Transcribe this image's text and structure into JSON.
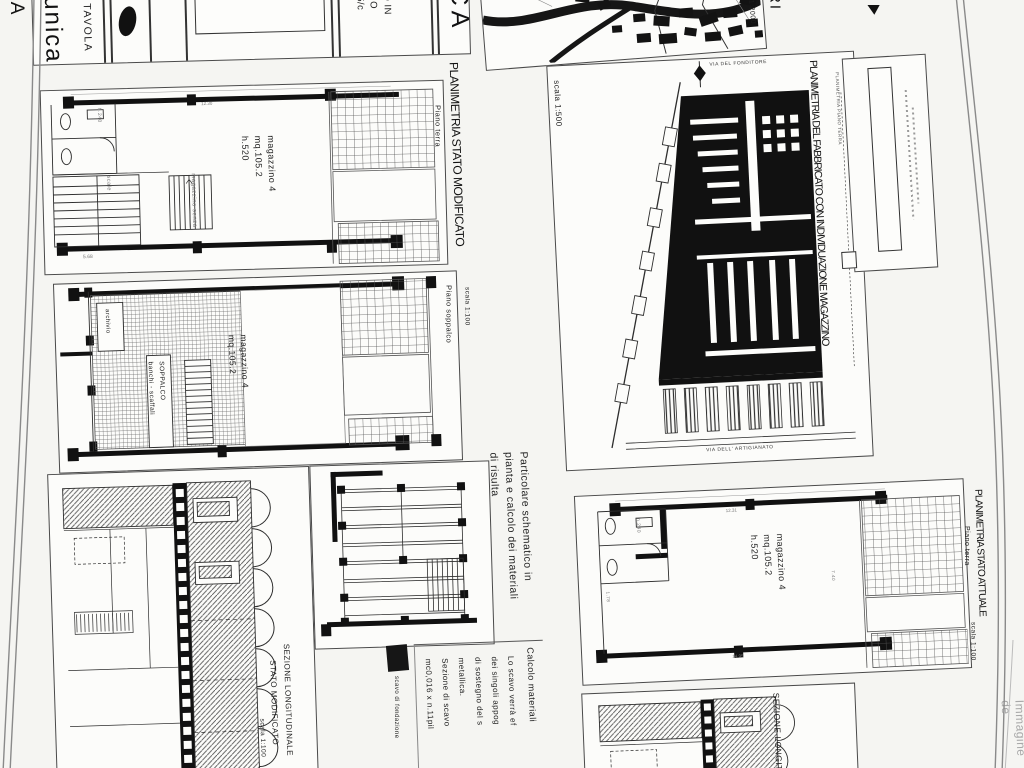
{
  "titleblock": {
    "tavola_label": "TAVOLA",
    "tavola_value": "unica",
    "ca_left": "CA",
    "ca_right": "CA",
    "ri_fragment": "RI",
    "frag1": "O IN",
    "frag2": "NO",
    "frag3": "5/c"
  },
  "map": {
    "scale": "la 1:2000"
  },
  "fabbricato": {
    "title": "PLANIMETRIA DEL FABBRICATO CON INDIVIDUAZIONE MAGAZZINO",
    "subtitle": "PLANIMETRIA PIANO TERRA",
    "scale": "scala 1:500",
    "street_top": "VIA DEL FONDITORE",
    "street_bottom": "VIA DELL' ARTIGIANATO"
  },
  "stato_modificato": {
    "title": "PLANIMETRIA STATO MODIFICATO",
    "scale": "scala 1:100",
    "terra": {
      "floor": "Piano terra",
      "room_label": "magazzino 4\nmq.105.2\nh.520",
      "bath_height": "h.240",
      "storage": "magazzino senza",
      "stairs": "scale",
      "dim_top": "12.30",
      "dim_bottom": "5.68"
    },
    "soppalco": {
      "floor": "Piano soppalco",
      "archive": "archivio",
      "mezzanine": "SOPPALCO\nbanchi - scaffali",
      "room_label": "magazzino 4\nmq.105.2"
    }
  },
  "sezione_modificato": {
    "line1": "SEZIONE LONGITUDINALE",
    "line2": "STATO MODIFICATO",
    "scale": "scala 1:100"
  },
  "particolare": {
    "title": "Particolare schematico in\npianta e calcolo dei materiali\ndi risulta",
    "legend": "scavo di fondazione",
    "calc_title": "Calcolo materiali",
    "calc_body": "Lo scavo verrà ef\ndei singoli appog\ndi sostegno del s\nmetallica.\nSezione di scavo\nmc0,016 x n.11pil"
  },
  "stato_attuale": {
    "title": "PLANIMETRIA STATO ATTUALE",
    "floor": "Piano terra",
    "scale": "scala 1:100",
    "room_label": "magazzino 4\nmq.105.2\nh.520",
    "bath_height": "h.240",
    "dim_left": "1.78",
    "dim_top": "12.31",
    "dim_bottom": "14.95",
    "dim_right": "7.40"
  },
  "sezione_attuale": {
    "title": "SEZIONE LONGIT"
  },
  "watermark": "Immagine de",
  "colors": {
    "ink": "#1e1e1e",
    "paper": "#f5f5f2",
    "line": "#4a4a4a"
  }
}
